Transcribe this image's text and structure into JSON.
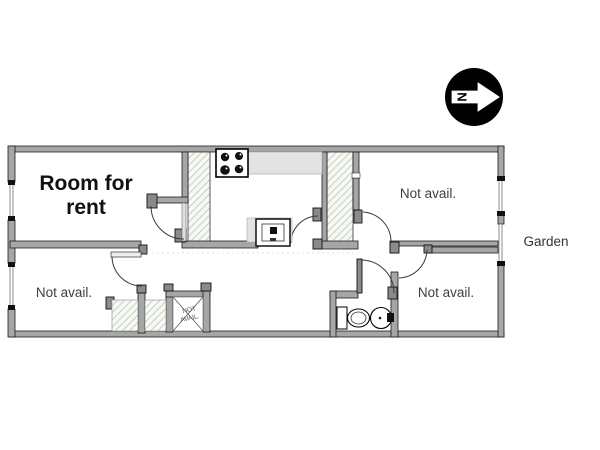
{
  "plan": {
    "rooms": {
      "room_for_rent": {
        "line1": "Room for",
        "line2": "rent"
      },
      "top_right": {
        "label": "Not avail."
      },
      "bottom_left": {
        "label": "Not avail."
      },
      "bottom_right": {
        "label": "Not avail."
      }
    },
    "closet": {
      "line1": "NOT",
      "line2": "AVAIL."
    },
    "outside": {
      "garden": "Garden"
    },
    "compass": {
      "north": "N"
    }
  },
  "colors": {
    "background": "#ffffff",
    "wall_fill": "#a6a6a6",
    "wall_dark": "#8a8a8a",
    "wall_outline": "#1c1c1c",
    "counter_fill": "#e3e3e3",
    "hatch_stroke": "#b9c6b4",
    "door_arc": "#3a3a3a",
    "text_dark": "#111111",
    "text_gray": "#3f3f3f"
  }
}
